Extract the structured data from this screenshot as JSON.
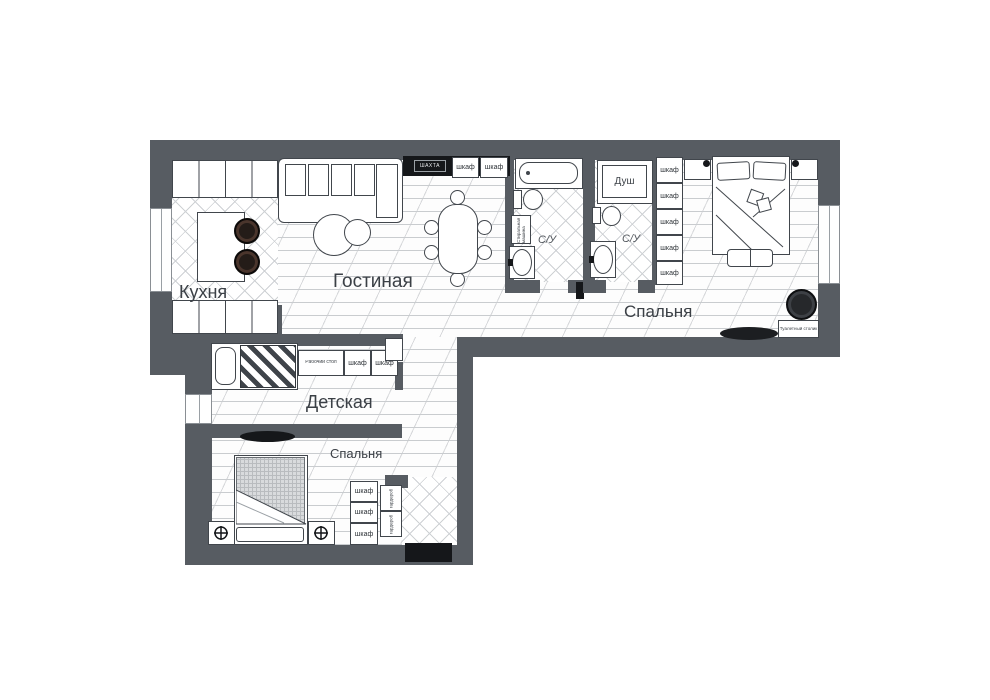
{
  "labels": {
    "kitchen": "Кухня",
    "living": "Гостиная",
    "kids": "Детская",
    "bedroom_right": "Спальня",
    "bedroom_bottom": "Спальня",
    "wc": "С/У",
    "shower": "Душ",
    "wardrobe": "шкаф",
    "closet": "гардероб",
    "desk": "Рабочий стол",
    "dressing": "Туалетный столик",
    "washer": "Стиральная машина",
    "shaft": "ШАХТА"
  },
  "colors": {
    "wall": "#575c62",
    "furniture_line": "#41464c",
    "hatch": "#c9cccf",
    "black": "#15171a",
    "text": "#3b4046",
    "background": "#ffffff"
  }
}
